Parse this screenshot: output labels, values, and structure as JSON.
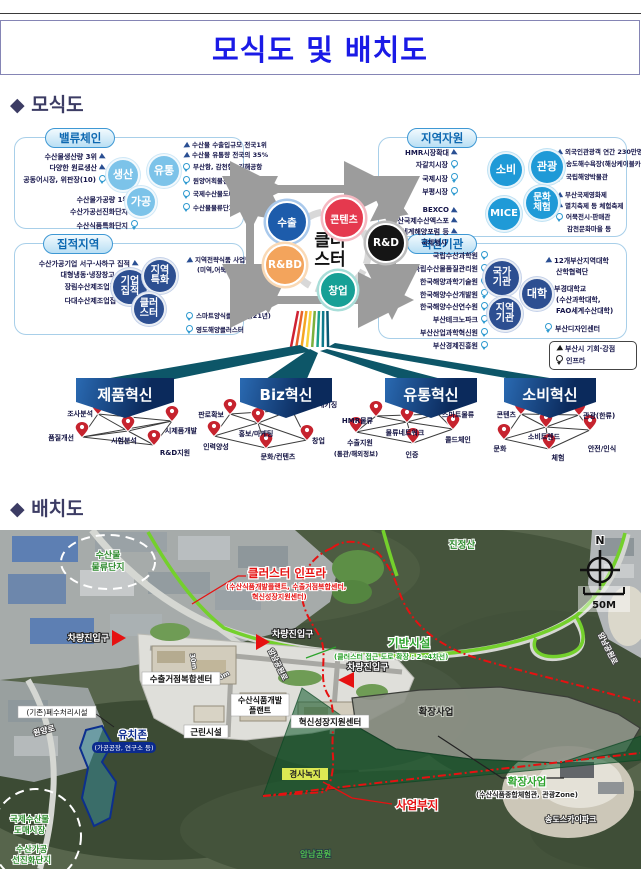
{
  "header": {
    "title": "모식도 및 배치도"
  },
  "sections": {
    "schematic": "◆ 모식도",
    "layout": "◆ 배치도"
  },
  "schematic": {
    "panels": {
      "value_chain": {
        "title": "밸류체인",
        "circles": [
          "생산",
          "유통",
          "가공"
        ],
        "left": [
          {
            "icon": "arrow",
            "text": "수산물생산량 3위"
          },
          {
            "icon": "arrow",
            "text": "다양한 원료생산"
          },
          {
            "icon": "pin",
            "text": "공동어시장, 위판장(10)"
          }
        ],
        "bottom": [
          {
            "icon": "arrow",
            "text": "수산물가공량 1위"
          },
          {
            "icon": "pin",
            "text": "수산가공선진화단지"
          },
          {
            "icon": "pin",
            "text": "수산식품특화단지"
          }
        ],
        "right": [
          {
            "icon": "arrow",
            "text": "수산물 수출입규모 전국1위"
          },
          {
            "icon": "arrow",
            "text": "수산물 유통량 전국의 35%"
          },
          {
            "icon": "pin",
            "text": "부산항, 감천항, 김해공항"
          },
          {
            "icon": "pin",
            "text": "원양어획물전용부두"
          },
          {
            "icon": "pin",
            "text": "국제수산물도매시장"
          },
          {
            "icon": "pin",
            "text": "수산물물류단지"
          }
        ]
      },
      "regional": {
        "title": "지역자원",
        "circles": [
          "소비",
          "관광",
          "문화\n체험",
          "MICE"
        ],
        "left": [
          {
            "icon": "arrow",
            "text": "HMR시장확대"
          },
          {
            "icon": "pin",
            "text": "자갈치시장"
          },
          {
            "icon": "pin",
            "text": "국제시장"
          },
          {
            "icon": "pin",
            "text": "부평시장"
          },
          {
            "icon": "arrow",
            "text": "BEXCO"
          },
          {
            "icon": "arrow",
            "text": "부산국제수산엑스포"
          },
          {
            "icon": "arrow",
            "text": "세계해양포럼 등"
          },
          {
            "icon": "none",
            "text": "국제행사"
          }
        ],
        "right": [
          {
            "icon": "arrow",
            "text": "외국인관광객 연간 230만명"
          },
          {
            "icon": "pin",
            "text": "송도해수욕장(해상케이블카)"
          },
          {
            "icon": "pin",
            "text": "국립해양박물관"
          },
          {
            "icon": "arrow",
            "text": "부산국제영화제"
          },
          {
            "icon": "arrow",
            "text": "멸치축제 등 체험축제"
          },
          {
            "icon": "pin",
            "text": "어묵전시·판매관"
          },
          {
            "icon": "none",
            "text": "감천문화마을 등"
          }
        ]
      },
      "cluster_area": {
        "title": "집적지역",
        "circles": [
          "기업\n집적",
          "지역\n특화",
          "클러\n스터"
        ],
        "left": [
          {
            "icon": "arrow",
            "text": "수산가공기업 서구·사하구 집적"
          },
          {
            "icon": "arrow",
            "text": "대형냉동·냉장창고 집적"
          },
          {
            "icon": "pin",
            "text": "장림수산제조업집적지"
          },
          {
            "icon": "pin",
            "text": "다대수산제조업집적지"
          }
        ],
        "right": [
          {
            "icon": "arrow",
            "text": "지역전략식품 사업단"
          },
          {
            "icon": "none",
            "text": "(미역,어묵,고등어)"
          },
          {
            "icon": "pin",
            "text": "스마트양식클러스터(21년)"
          },
          {
            "icon": "pin",
            "text": "영도해양클러스터"
          }
        ]
      },
      "innovation": {
        "title": "혁신기관",
        "circles": [
          "국가\n기관",
          "대학",
          "지역\n기관"
        ],
        "left": [
          {
            "icon": "pin",
            "text": "국립수산과학원"
          },
          {
            "icon": "pin",
            "text": "국립수산물품질관리원"
          },
          {
            "icon": "pin",
            "text": "한국해양과학기술원"
          },
          {
            "icon": "pin",
            "text": "한국해양수산개발원"
          },
          {
            "icon": "pin",
            "text": "한국해양수산연수원"
          },
          {
            "icon": "pin",
            "text": "부산테크노파크"
          },
          {
            "icon": "pin",
            "text": "부산산업과학혁신원"
          },
          {
            "icon": "pin",
            "text": "부산경제진흥원"
          }
        ],
        "right": [
          {
            "icon": "arrow",
            "text": "12개부산지역대학"
          },
          {
            "icon": "none",
            "text": "산학협력단"
          },
          {
            "icon": "arrow",
            "text": "부경대학교"
          },
          {
            "icon": "none",
            "text": "(수산과학대학,"
          },
          {
            "icon": "none",
            "text": "FAO세계수산대학)"
          },
          {
            "icon": "pin",
            "text": "부산디자인센터"
          }
        ]
      }
    },
    "center": {
      "label": "클러\n스터",
      "satellites": [
        {
          "label": "수출",
          "color": "#1d5cab"
        },
        {
          "label": "콘텐츠",
          "color": "#e5394e"
        },
        {
          "label": "R&BD",
          "color": "#f3a45c"
        },
        {
          "label": "R&D",
          "color": "#151515"
        },
        {
          "label": "창업",
          "color": "#16a096"
        }
      ]
    },
    "groups": [
      {
        "banner": "제품혁신",
        "nodes": [
          "조사분석",
          "품질개선",
          "시험분석",
          "시제품개발",
          "R&D지원"
        ]
      },
      {
        "banner": "Biz혁신",
        "nodes": [
          "판로확보",
          "디자인/패키징",
          "홍보/마케팅",
          "인력양성",
          "창업",
          "문화/컨텐츠"
        ]
      },
      {
        "banner": "유통혁신",
        "nodes": [
          "HMR물류",
          "스마트물류",
          "물류네트워크",
          "수출지원",
          "콜드체인",
          "인증"
        ],
        "sub": "(통관/해외정보)"
      },
      {
        "banner": "소비혁신",
        "nodes": [
          "콘텐츠",
          "관광(한류)",
          "소비트렌드",
          "문화",
          "안전/인식",
          "체험"
        ]
      }
    ],
    "legend": [
      {
        "icon": "arrow",
        "text": "부산시 기회·강점"
      },
      {
        "icon": "pin",
        "text": "인프라"
      }
    ]
  },
  "map": {
    "mountain": "진정산",
    "north": "N",
    "scale": "50M",
    "logistics_zone": {
      "lines": [
        "수산물",
        "물류단지"
      ]
    },
    "cluster_infra": {
      "title": "클러스터 인프라",
      "sub1": "(수산식품개발플랜트, 수출거점복합센터,",
      "sub2": "혁신성장지원센터)"
    },
    "entrance": "차량진입구",
    "base_infra": {
      "title": "기반시설",
      "sub": "(클러스터 접근 도로 확장 : 2→4차선)"
    },
    "road_amnam": "암남공원로",
    "road_wonyang": "원양로",
    "wastewater": "(기존)폐수처리시설",
    "export_center": "수출거점복합센터",
    "food_plant": {
      "lines": [
        "수산식품개발",
        "플랜트"
      ]
    },
    "innov_center": "혁신성장지원센터",
    "neighborhood": "근린시설",
    "dim_30m": "30m",
    "attract_zone": {
      "title": "유치존",
      "sub": "(가공공장, 연구소 등)"
    },
    "slope_green": "경사녹지",
    "expansion_area": "확장사업",
    "expansion_label": {
      "title": "확장사업",
      "sub": "(수산식품종합체험관, 관광Zone)"
    },
    "site_label": "사업부지",
    "wholesale_zone": {
      "lines": [
        "국제수산물",
        "도매시장",
        "수산가공",
        "선진화단지"
      ]
    },
    "skypark": "송도스카이파크",
    "park": "암남공원"
  }
}
